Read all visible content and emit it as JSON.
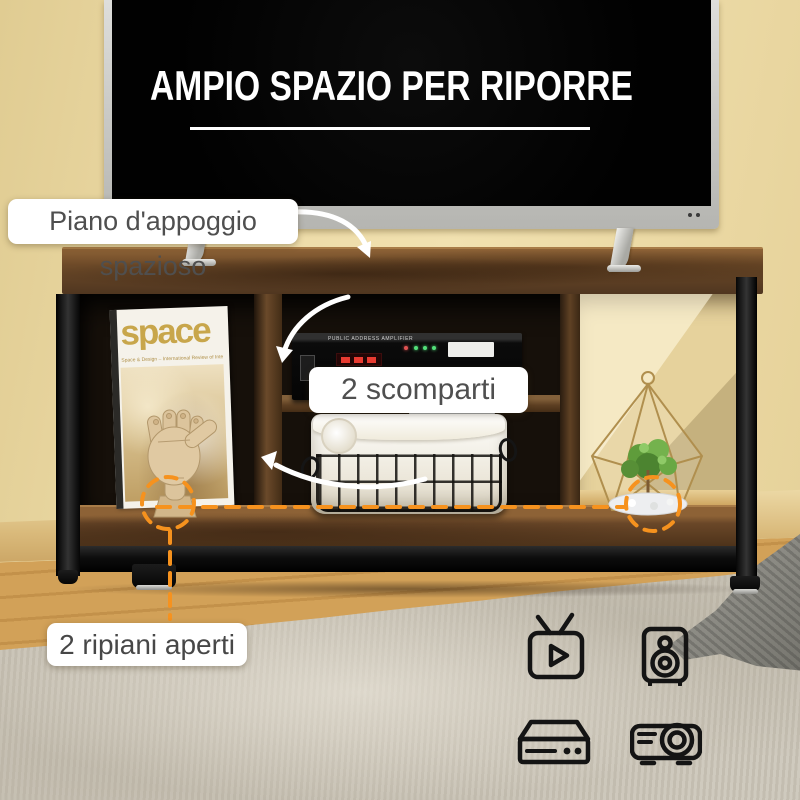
{
  "banner": {
    "title": "AMPIO SPAZIO PER RIPORRE"
  },
  "callouts": {
    "surface": {
      "label": "Piano d'appoggio spazioso"
    },
    "compartments": {
      "label": "2 scomparti"
    },
    "shelves": {
      "label": "2 ripiani aperti"
    }
  },
  "props": {
    "magazine": {
      "title": "space",
      "subtitle": "Space & Design – International Review of Interior Design"
    },
    "amplifier": {
      "label": "PUBLIC ADDRESS AMPLIFIER"
    }
  },
  "icons": [
    {
      "name": "tv-icon"
    },
    {
      "name": "speaker-icon"
    },
    {
      "name": "media-player-icon"
    },
    {
      "name": "projector-icon"
    }
  ],
  "colors": {
    "accent_orange": "#F6921E",
    "banner_text": "#FFFFFF",
    "label_text": "#4F4F4F",
    "wall": "#EBD9A4",
    "wood": "#6B4A2A",
    "metal": "#161616",
    "floor": "#CD9B51",
    "carpet": "#CBC5B8"
  }
}
